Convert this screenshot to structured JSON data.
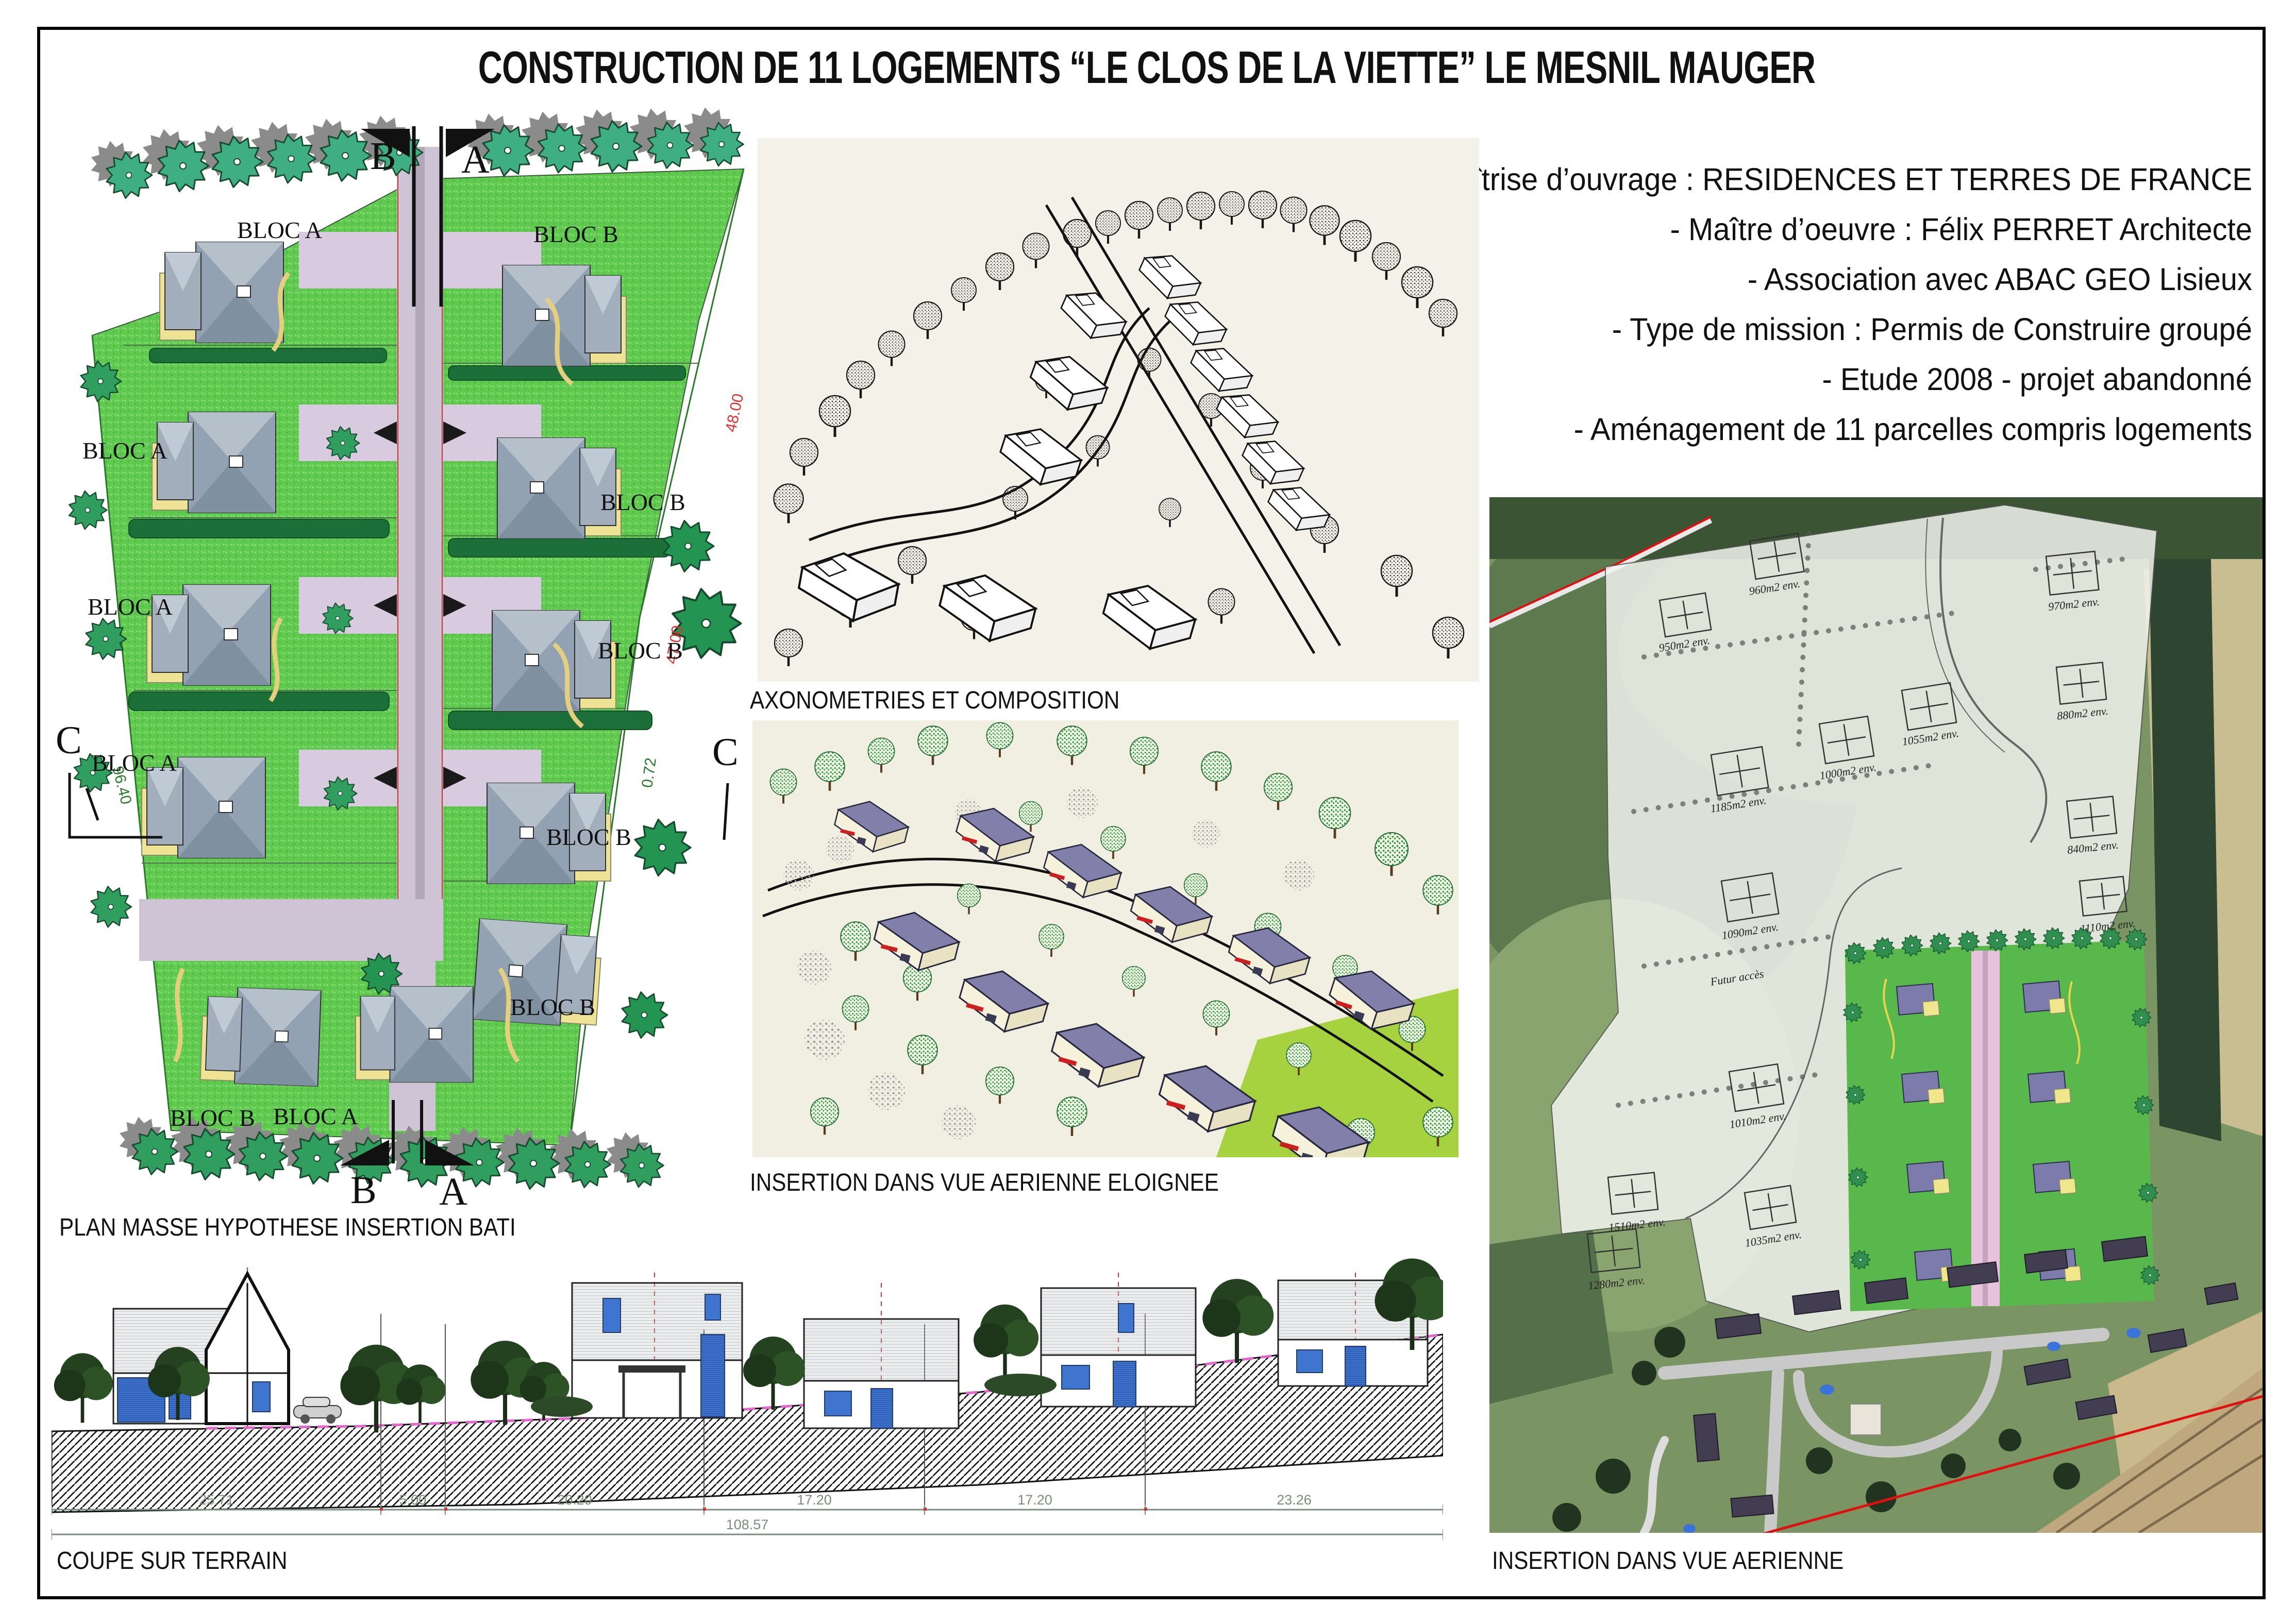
{
  "title": "CONSTRUCTION DE 11 LOGEMENTS “LE CLOS DE LA VIETTE” LE MESNIL MAUGER",
  "info": {
    "lines": [
      "- Maîtrise d’ouvrage : RESIDENCES ET TERRES DE FRANCE",
      "- Maître d’oeuvre : Félix PERRET Architecte",
      "- Association avec ABAC GEO Lisieux",
      "- Type de mission : Permis de Construire groupé",
      "- Etude 2008 - projet abandonné",
      "- Aménagement de 11 parcelles compris logements"
    ]
  },
  "plan_masse": {
    "label": "PLAN MASSE HYPOTHESE INSERTION BATI",
    "bloc_a": "BLOC A",
    "bloc_b": "BLOC B",
    "markers": {
      "a": "A",
      "b": "B",
      "c": "C"
    },
    "dims": {
      "left_boundary": "96.40",
      "right_top": "48.00",
      "right_mid": "47.00",
      "right_small": "0.72"
    }
  },
  "axonometry": {
    "label": "AXONOMETRIES ET COMPOSITION"
  },
  "insertion_far": {
    "label": "INSERTION DANS VUE AERIENNE ELOIGNEE"
  },
  "aerial": {
    "label": "INSERTION DANS VUE AERIENNE",
    "futur_acces": "Futur accès",
    "parcels": [
      "960m2 env.",
      "950m2 env.",
      "970m2 env.",
      "1185m2 env.",
      "1000m2 env.",
      "1055m2 env.",
      "880m2 env.",
      "840m2 env.",
      "1090m2 env.",
      "1010m2 env.",
      "1035m2 env.",
      "1280m2 env.",
      "1110m2 env.",
      "1510m2 env."
    ]
  },
  "section": {
    "label": "COUPE SUR TERRAIN",
    "dims": [
      "25.71",
      "5.00",
      "20.20",
      "17.20",
      "17.20",
      "23.26"
    ],
    "total": "108.57"
  },
  "colors": {
    "lawn": "#5fca4f",
    "road": "#cfc3d6",
    "roof_plan": "#93a2b2",
    "patio": "#eee394",
    "tree": "#35ad7c",
    "roof_axo": "#8280ab",
    "accent_red": "#cc2020",
    "terrain_pink": "#e566cc",
    "dim_text": "#7d8d7d",
    "red_line": "#e01010"
  }
}
